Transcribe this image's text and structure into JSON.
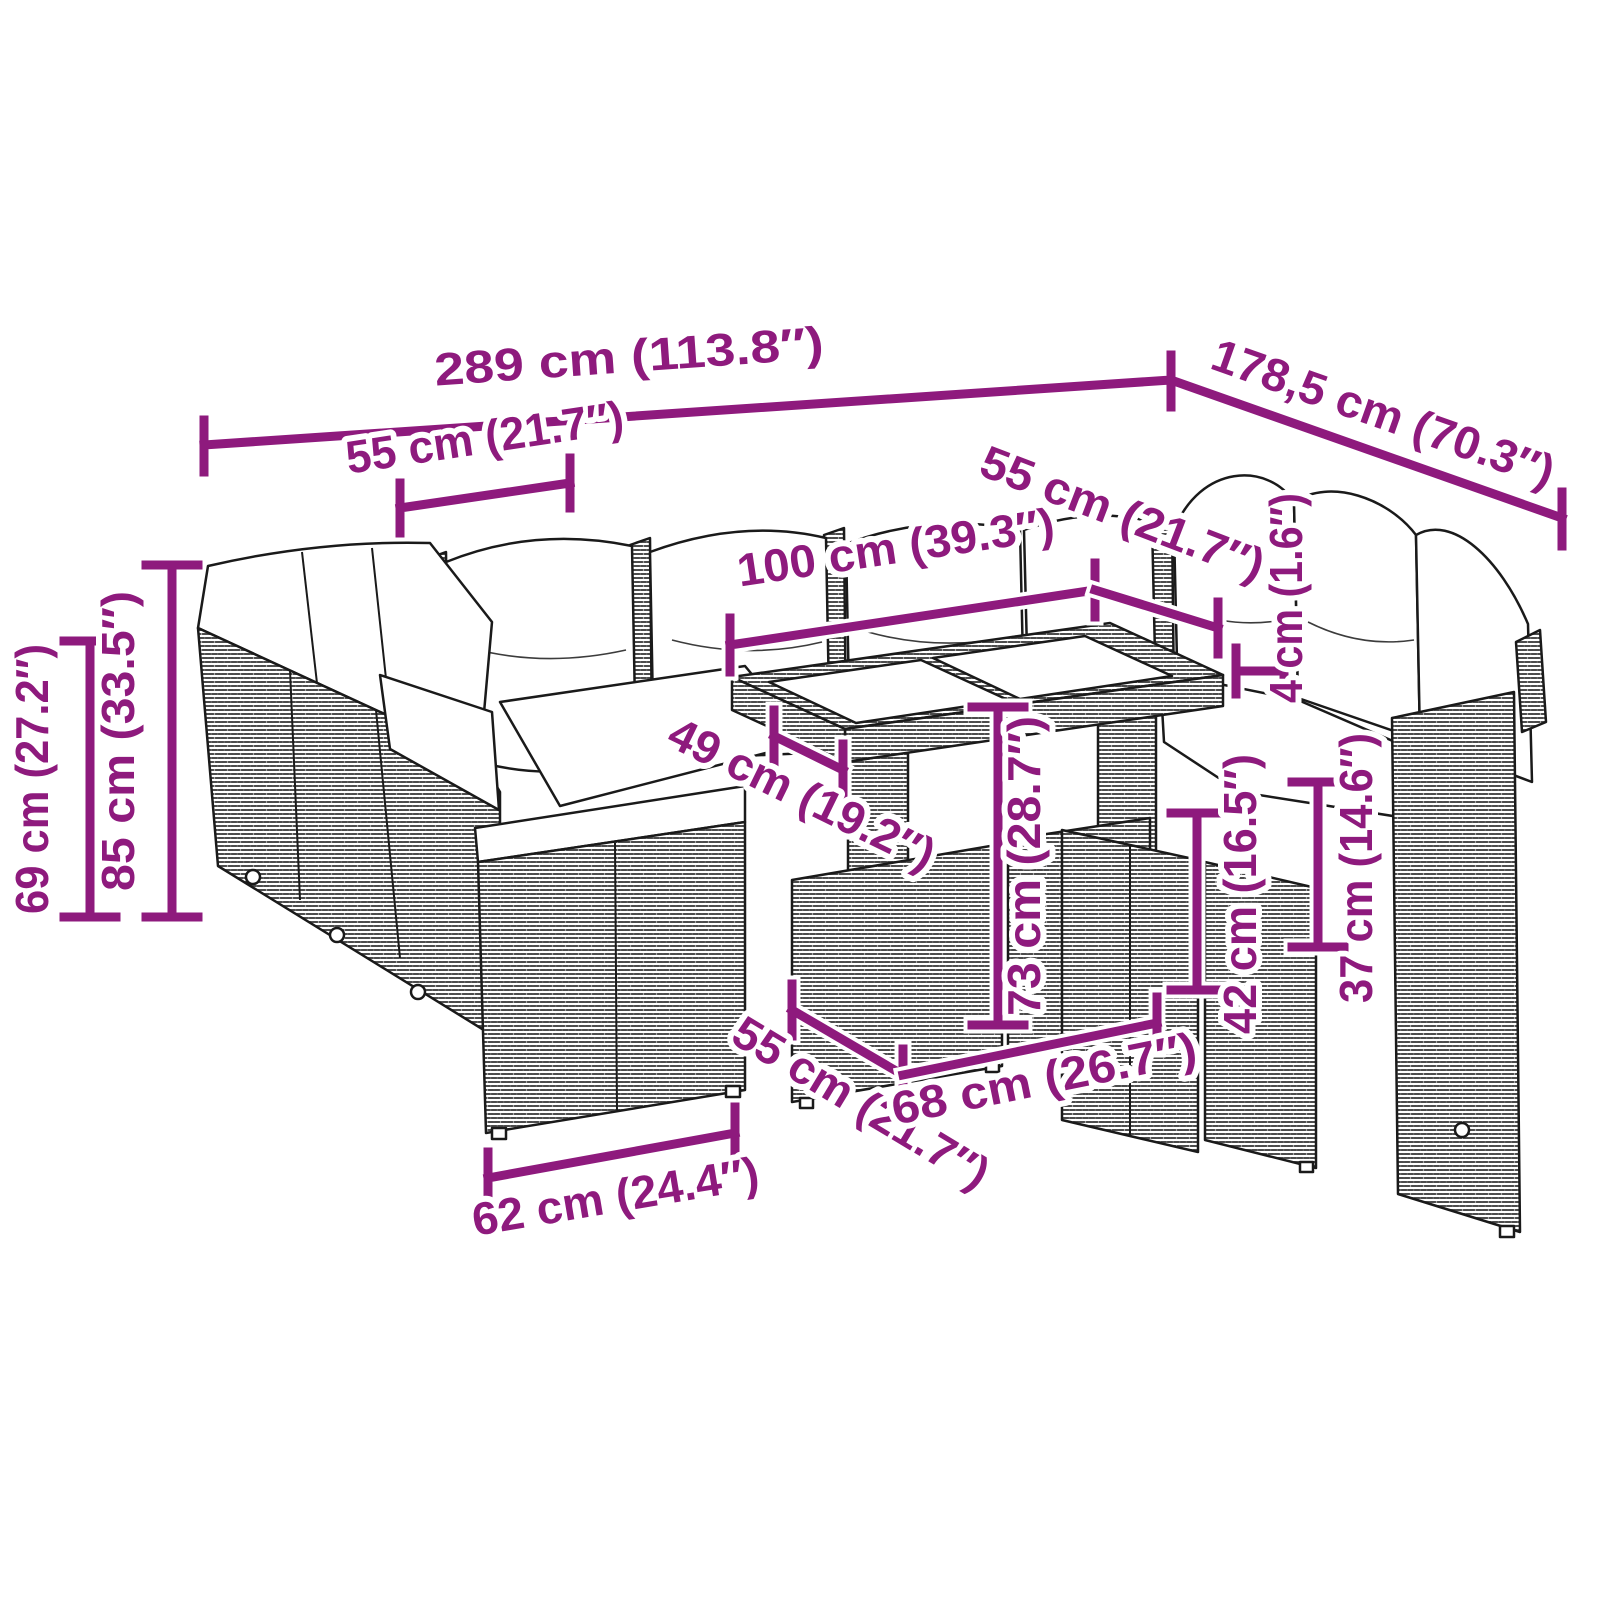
{
  "diagram": {
    "type": "product-dimension-diagram",
    "subject": "modular garden lounge set with cushions and two-top table",
    "units": {
      "primary": "cm",
      "secondary": "inch"
    }
  },
  "colors": {
    "dimension_accent": "#8e1a7d",
    "line_art": "#1a1a1a",
    "background": "#ffffff",
    "cushion": "#ffffff"
  },
  "dimensions": [
    {
      "id": "overall-width",
      "label": "289 cm (113.8″)",
      "cm": 289,
      "inches": 113.8
    },
    {
      "id": "overall-depth",
      "label": "178,5 cm (70.3″)",
      "cm": 178.5,
      "inches": 70.3
    },
    {
      "id": "back-cushion-width",
      "label": "55 cm (21.7″)",
      "cm": 55,
      "inches": 21.7
    },
    {
      "id": "table-top-length",
      "label": "100 cm (39.3″)",
      "cm": 100,
      "inches": 39.3
    },
    {
      "id": "right-seat-width",
      "label": "55 cm (21.7″)",
      "cm": 55,
      "inches": 21.7
    },
    {
      "id": "arm-height",
      "label": "69 cm (27.2″)",
      "cm": 69,
      "inches": 27.2
    },
    {
      "id": "backrest-height",
      "label": "85 cm (33.5″)",
      "cm": 85,
      "inches": 33.5
    },
    {
      "id": "table-overhang",
      "label": "49 cm (19.2″)",
      "cm": 49,
      "inches": 19.2
    },
    {
      "id": "table-height",
      "label": "73 cm (28.7″)",
      "cm": 73,
      "inches": 28.7
    },
    {
      "id": "cushion-thickness",
      "label": "4 cm (1.6″)",
      "cm": 4,
      "inches": 1.6
    },
    {
      "id": "ottoman-height",
      "label": "42 cm (16.5″)",
      "cm": 42,
      "inches": 16.5
    },
    {
      "id": "seat-height",
      "label": "37 cm (14.6″)",
      "cm": 37,
      "inches": 14.6
    },
    {
      "id": "table-depth",
      "label": "55 cm (21.7″)",
      "cm": 55,
      "inches": 21.7
    },
    {
      "id": "table-base-width",
      "label": "68 cm (26.7″)",
      "cm": 68,
      "inches": 26.7
    },
    {
      "id": "seat-module-width",
      "label": "62 cm (24.4″)",
      "cm": 62,
      "inches": 24.4
    }
  ]
}
